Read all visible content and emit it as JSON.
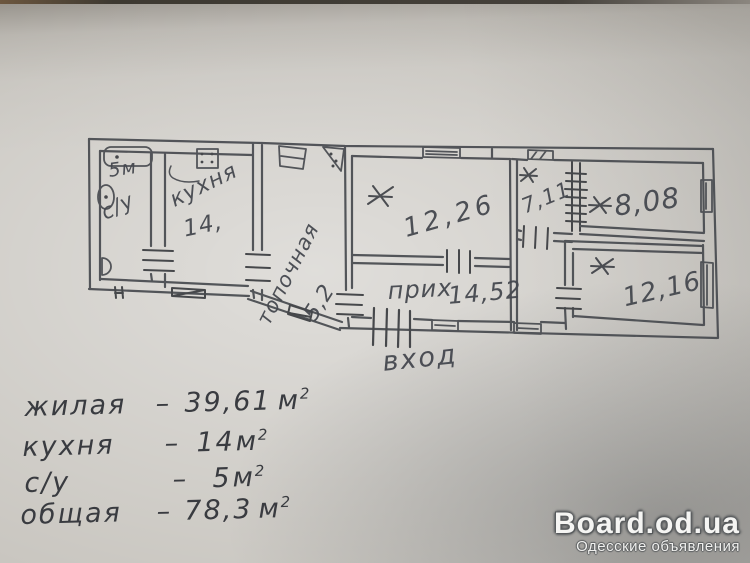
{
  "floor_plan": {
    "rooms": [
      {
        "id": "bathroom",
        "label": "с/у",
        "area": "5м"
      },
      {
        "id": "kitchen",
        "label": "кухня",
        "area": "14,"
      },
      {
        "id": "boiler-room",
        "label": "топочная",
        "area": "5,2"
      },
      {
        "id": "living-room-1",
        "marker": "✱",
        "area": "12,26"
      },
      {
        "id": "living-room-2",
        "marker": "✱",
        "area": "7,11"
      },
      {
        "id": "living-room-3",
        "marker": "✱",
        "area": "8,08"
      },
      {
        "id": "living-room-4",
        "marker": "✱",
        "area": "12,16"
      },
      {
        "id": "hallway",
        "label": "прих",
        "area": "14,52"
      }
    ],
    "entrance_label": "вход"
  },
  "summary": {
    "rows": [
      {
        "label": "жилая",
        "dash": "–",
        "value": "39,61",
        "unit": "м",
        "sup": "2"
      },
      {
        "label": "кухня",
        "dash": "–",
        "value": "14",
        "unit": "м",
        "sup": "2"
      },
      {
        "label": "с/у",
        "dash": "–",
        "value": "5",
        "unit": "м",
        "sup": "2"
      },
      {
        "label": "общая",
        "dash": "–",
        "value": "78,3",
        "unit": "м",
        "sup": "2"
      }
    ]
  },
  "watermark": {
    "site": "Board.od.ua",
    "tagline": "Одесские объявления"
  }
}
